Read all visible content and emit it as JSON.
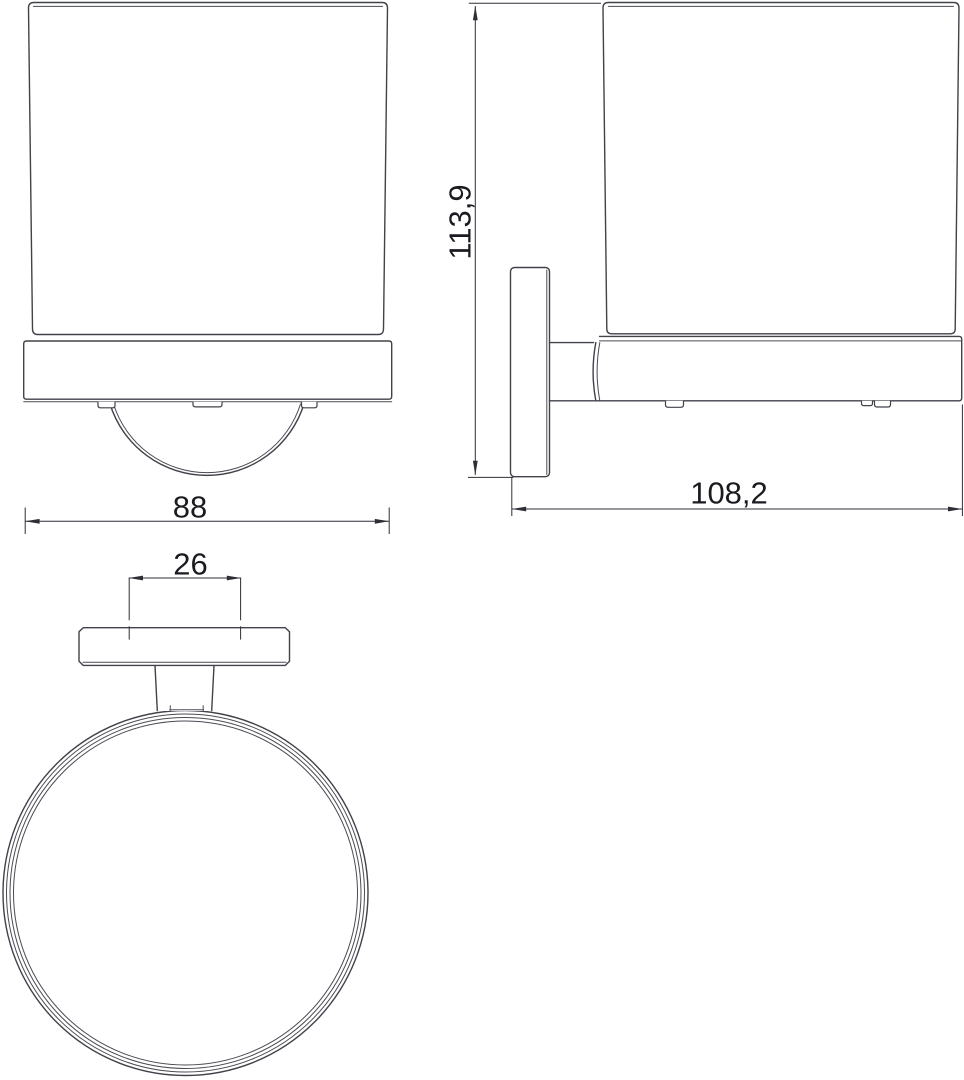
{
  "drawing": {
    "type": "technical-drawing",
    "background": "#ffffff",
    "object_line_color": "#41424a",
    "dimension_line_color": "#2e2f36",
    "text_color": "#1a1b20"
  },
  "views": {
    "front": {
      "name": "front view of wall-mounted tumbler holder",
      "width_dim": "88"
    },
    "side": {
      "name": "side view of wall-mounted tumbler holder",
      "height_dim": "113,9",
      "depth_dim": "108,2"
    },
    "top": {
      "name": "top view of holder ring and wall plate",
      "mount_dim": "26"
    }
  }
}
